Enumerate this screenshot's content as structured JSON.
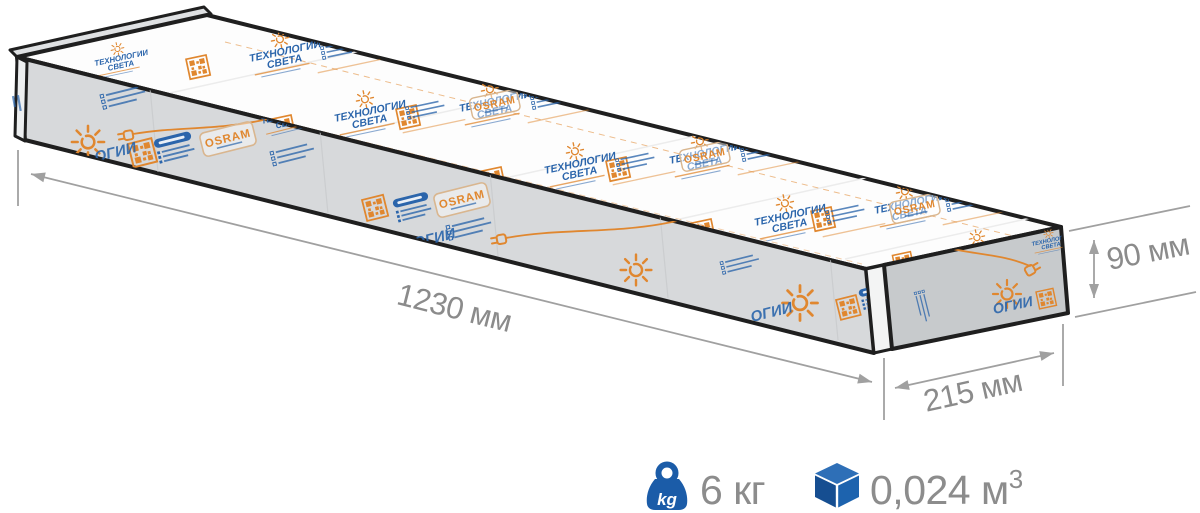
{
  "figure": {
    "type": "package-dimensions-illustration",
    "dimensions": {
      "length": "1230 мм",
      "width": "215 мм",
      "height": "90 мм"
    },
    "specs": {
      "weight": "6 кг",
      "weight_icon_text": "kg",
      "volume_base": "0,024 м",
      "volume_sup": "3"
    },
    "branding": {
      "line1": "ТЕХНОЛОГИИ",
      "line2": "СВЕТА",
      "logo": "OSRAM",
      "fragment": "ОГИИ"
    },
    "icons": {
      "weight": "kettlebell-kg-icon",
      "volume": "cube-icon"
    },
    "colors": {
      "accent_blue": "#1b5ca8",
      "print_blue": "#2b65ab",
      "print_orange": "#e0872f",
      "dim_text_gray": "#8b8b8b",
      "dim_line_gray": "#a0a0a0"
    }
  }
}
